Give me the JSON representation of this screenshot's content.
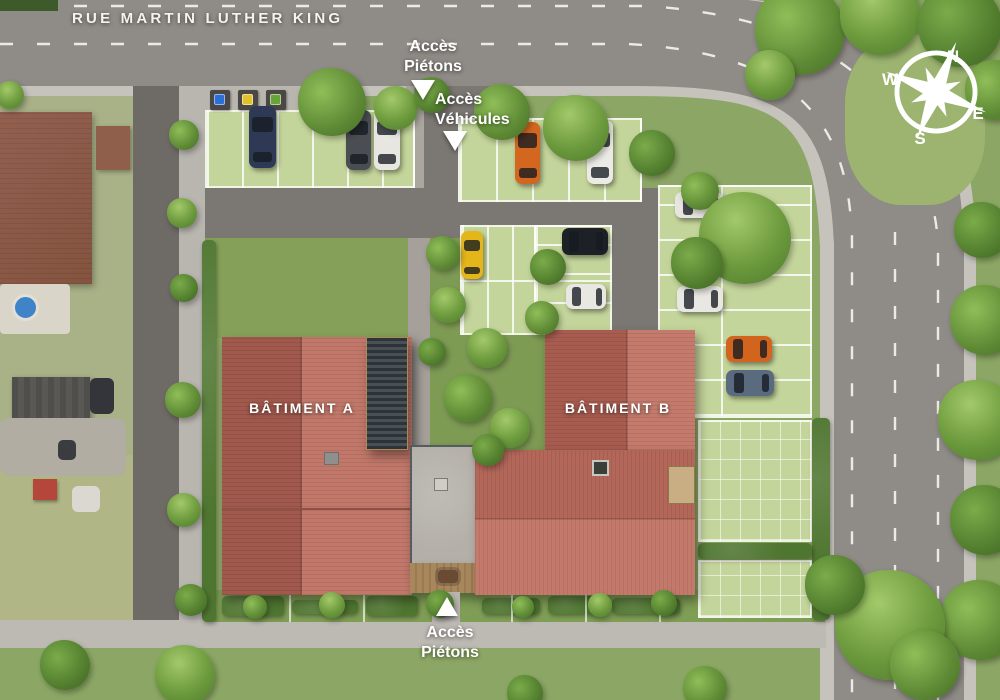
{
  "street": {
    "name": "RUE MARTIN LUTHER KING"
  },
  "labels": {
    "access_pedestrian_top": {
      "line1": "Accès",
      "line2": "Piétons"
    },
    "access_vehicles": {
      "line1": "Accès",
      "line2": "Véhicules"
    },
    "access_pedestrian_bottom": {
      "line1": "Accès",
      "line2": "Piétons"
    },
    "building_a": "BÂTIMENT A",
    "building_b": "BÂTIMENT B"
  },
  "compass": {
    "north": "N",
    "east": "E",
    "south": "S",
    "west": "W"
  },
  "colors": {
    "road": "#8f8b86",
    "sidewalk": "#c6c3bd",
    "driveway": "#7b7773",
    "parking_surface": "#c4d59b",
    "roof_dark": "#a1594d",
    "roof_light": "#c1786a",
    "grass": "#8ca765",
    "hedge": "#4f7630",
    "label_text": "#ffffff"
  },
  "cars": [
    {
      "color": "#2e3a55",
      "x": 249,
      "y": 106,
      "w": 27,
      "h": 62,
      "dir": "v"
    },
    {
      "color": "#4a4e52",
      "x": 346,
      "y": 110,
      "w": 25,
      "h": 60,
      "dir": "v"
    },
    {
      "color": "#e8e6e1",
      "x": 374,
      "y": 110,
      "w": 26,
      "h": 60,
      "dir": "v"
    },
    {
      "color": "#d4671f",
      "x": 515,
      "y": 122,
      "w": 25,
      "h": 62,
      "dir": "v"
    },
    {
      "color": "#eceae5",
      "x": 587,
      "y": 120,
      "w": 26,
      "h": 64,
      "dir": "v"
    },
    {
      "color": "#e5b619",
      "x": 461,
      "y": 231,
      "w": 22,
      "h": 48,
      "dir": "v"
    },
    {
      "color": "#1d2126",
      "x": 562,
      "y": 228,
      "w": 46,
      "h": 27,
      "dir": "h"
    },
    {
      "color": "#e9e7e2",
      "x": 566,
      "y": 284,
      "w": 40,
      "h": 25,
      "dir": "h"
    },
    {
      "color": "#e7e5e0",
      "x": 675,
      "y": 192,
      "w": 48,
      "h": 26,
      "dir": "h"
    },
    {
      "color": "#e9e7e2",
      "x": 677,
      "y": 286,
      "w": 46,
      "h": 26,
      "dir": "h"
    },
    {
      "color": "#d3641e",
      "x": 726,
      "y": 336,
      "w": 46,
      "h": 26,
      "dir": "h"
    },
    {
      "color": "#5a6b80",
      "x": 726,
      "y": 370,
      "w": 48,
      "h": 26,
      "dir": "h"
    }
  ],
  "bins": [
    {
      "color": "#2b6fd4"
    },
    {
      "color": "#e0c22c"
    },
    {
      "color": "#67a33a"
    }
  ]
}
